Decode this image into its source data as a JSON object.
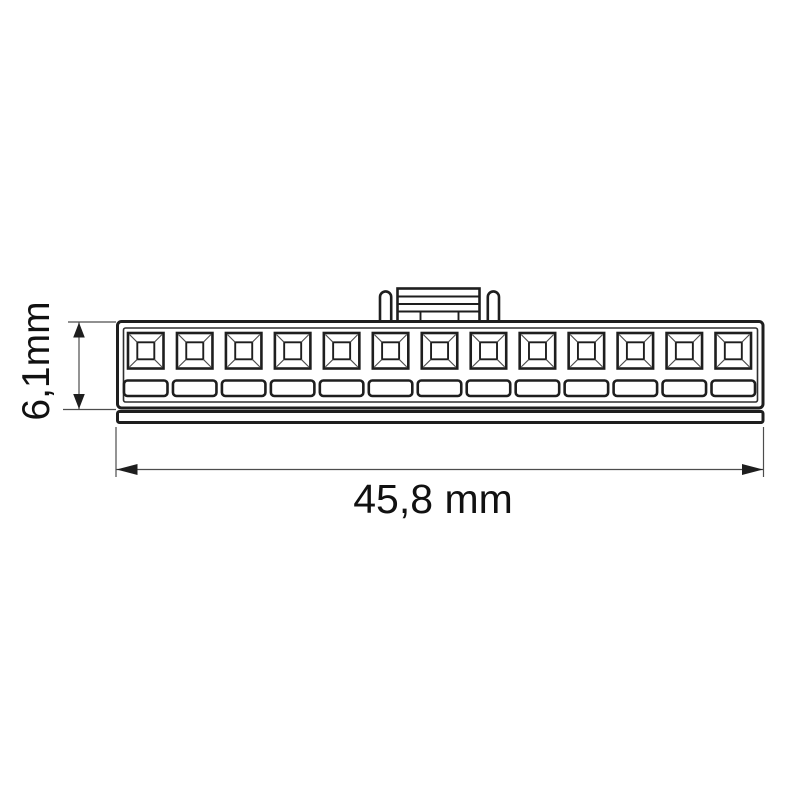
{
  "drawing": {
    "kind": "connector-housing-technical-drawing",
    "view": "front elevation",
    "pin_count": 13,
    "dimensions": {
      "height": {
        "label": "6,1mm",
        "value_mm": 6.1,
        "orientation": "vertical"
      },
      "width": {
        "label": "45,8 mm",
        "value_mm": 45.8,
        "orientation": "horizontal"
      }
    },
    "colors": {
      "line": "#1e1e1e",
      "dimension_line": "#4d4d4d",
      "text": "#111111",
      "background": "#ffffff"
    }
  }
}
